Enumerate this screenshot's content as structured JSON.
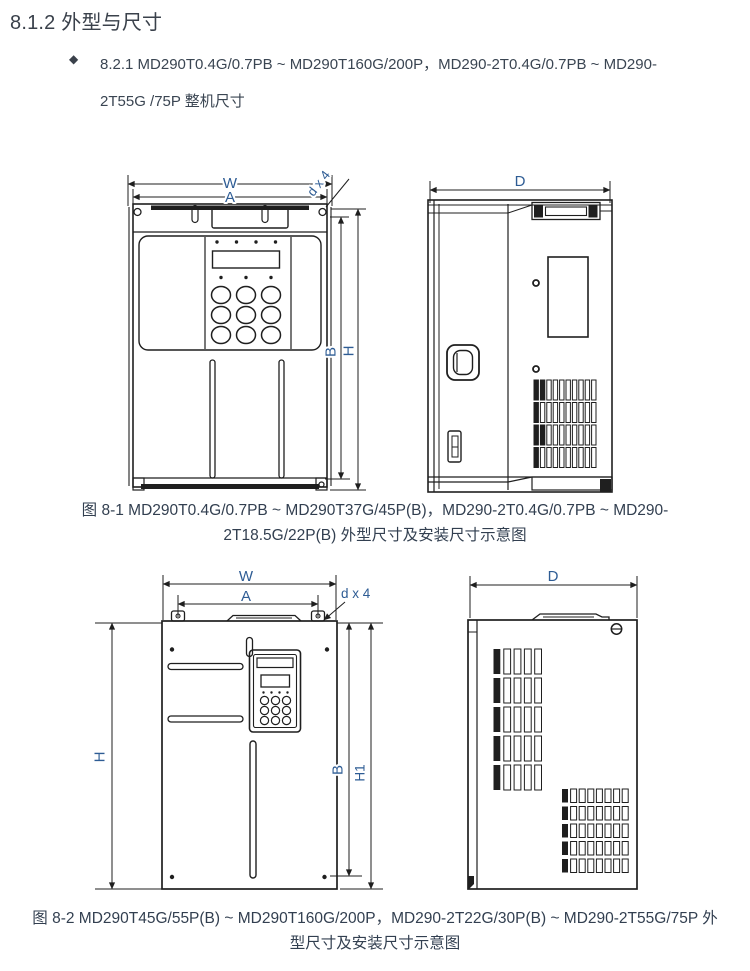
{
  "page": {
    "heading": "8.1.2 外型与尺寸",
    "bullet": {
      "marker": "◆",
      "line1": "8.2.1 MD290T0.4G/0.7PB ~ MD290T160G/200P，MD290-2T0.4G/0.7PB ~  MD290-",
      "line2": "2T55G /75P 整机尺寸"
    }
  },
  "figure1": {
    "dims": {
      "w": "W",
      "a": "A",
      "dx4": "d x 4",
      "b": "B",
      "h": "H",
      "d": "D"
    },
    "caption_line1": "图 8-1 MD290T0.4G/0.7PB ~ MD290T37G/45P(B)，MD290-2T0.4G/0.7PB ~ MD290-",
    "caption_line2": "2T18.5G/22P(B) 外型尺寸及安装尺寸示意图"
  },
  "figure2": {
    "dims": {
      "w": "W",
      "a": "A",
      "dx4": "d x 4",
      "h": "H",
      "b": "B",
      "h1": "H1",
      "d": "D"
    },
    "caption_line1": "图 8-2 MD290T45G/55P(B) ~ MD290T160G/200P，MD290-2T22G/30P(B) ~ MD290-2T55G/75P 外",
    "caption_line2": "型尺寸及安装尺寸示意图"
  },
  "colors": {
    "dimension_label": "#2e5c94",
    "body_text": "#333f4e",
    "drawing_line": "#1f1f1f"
  }
}
